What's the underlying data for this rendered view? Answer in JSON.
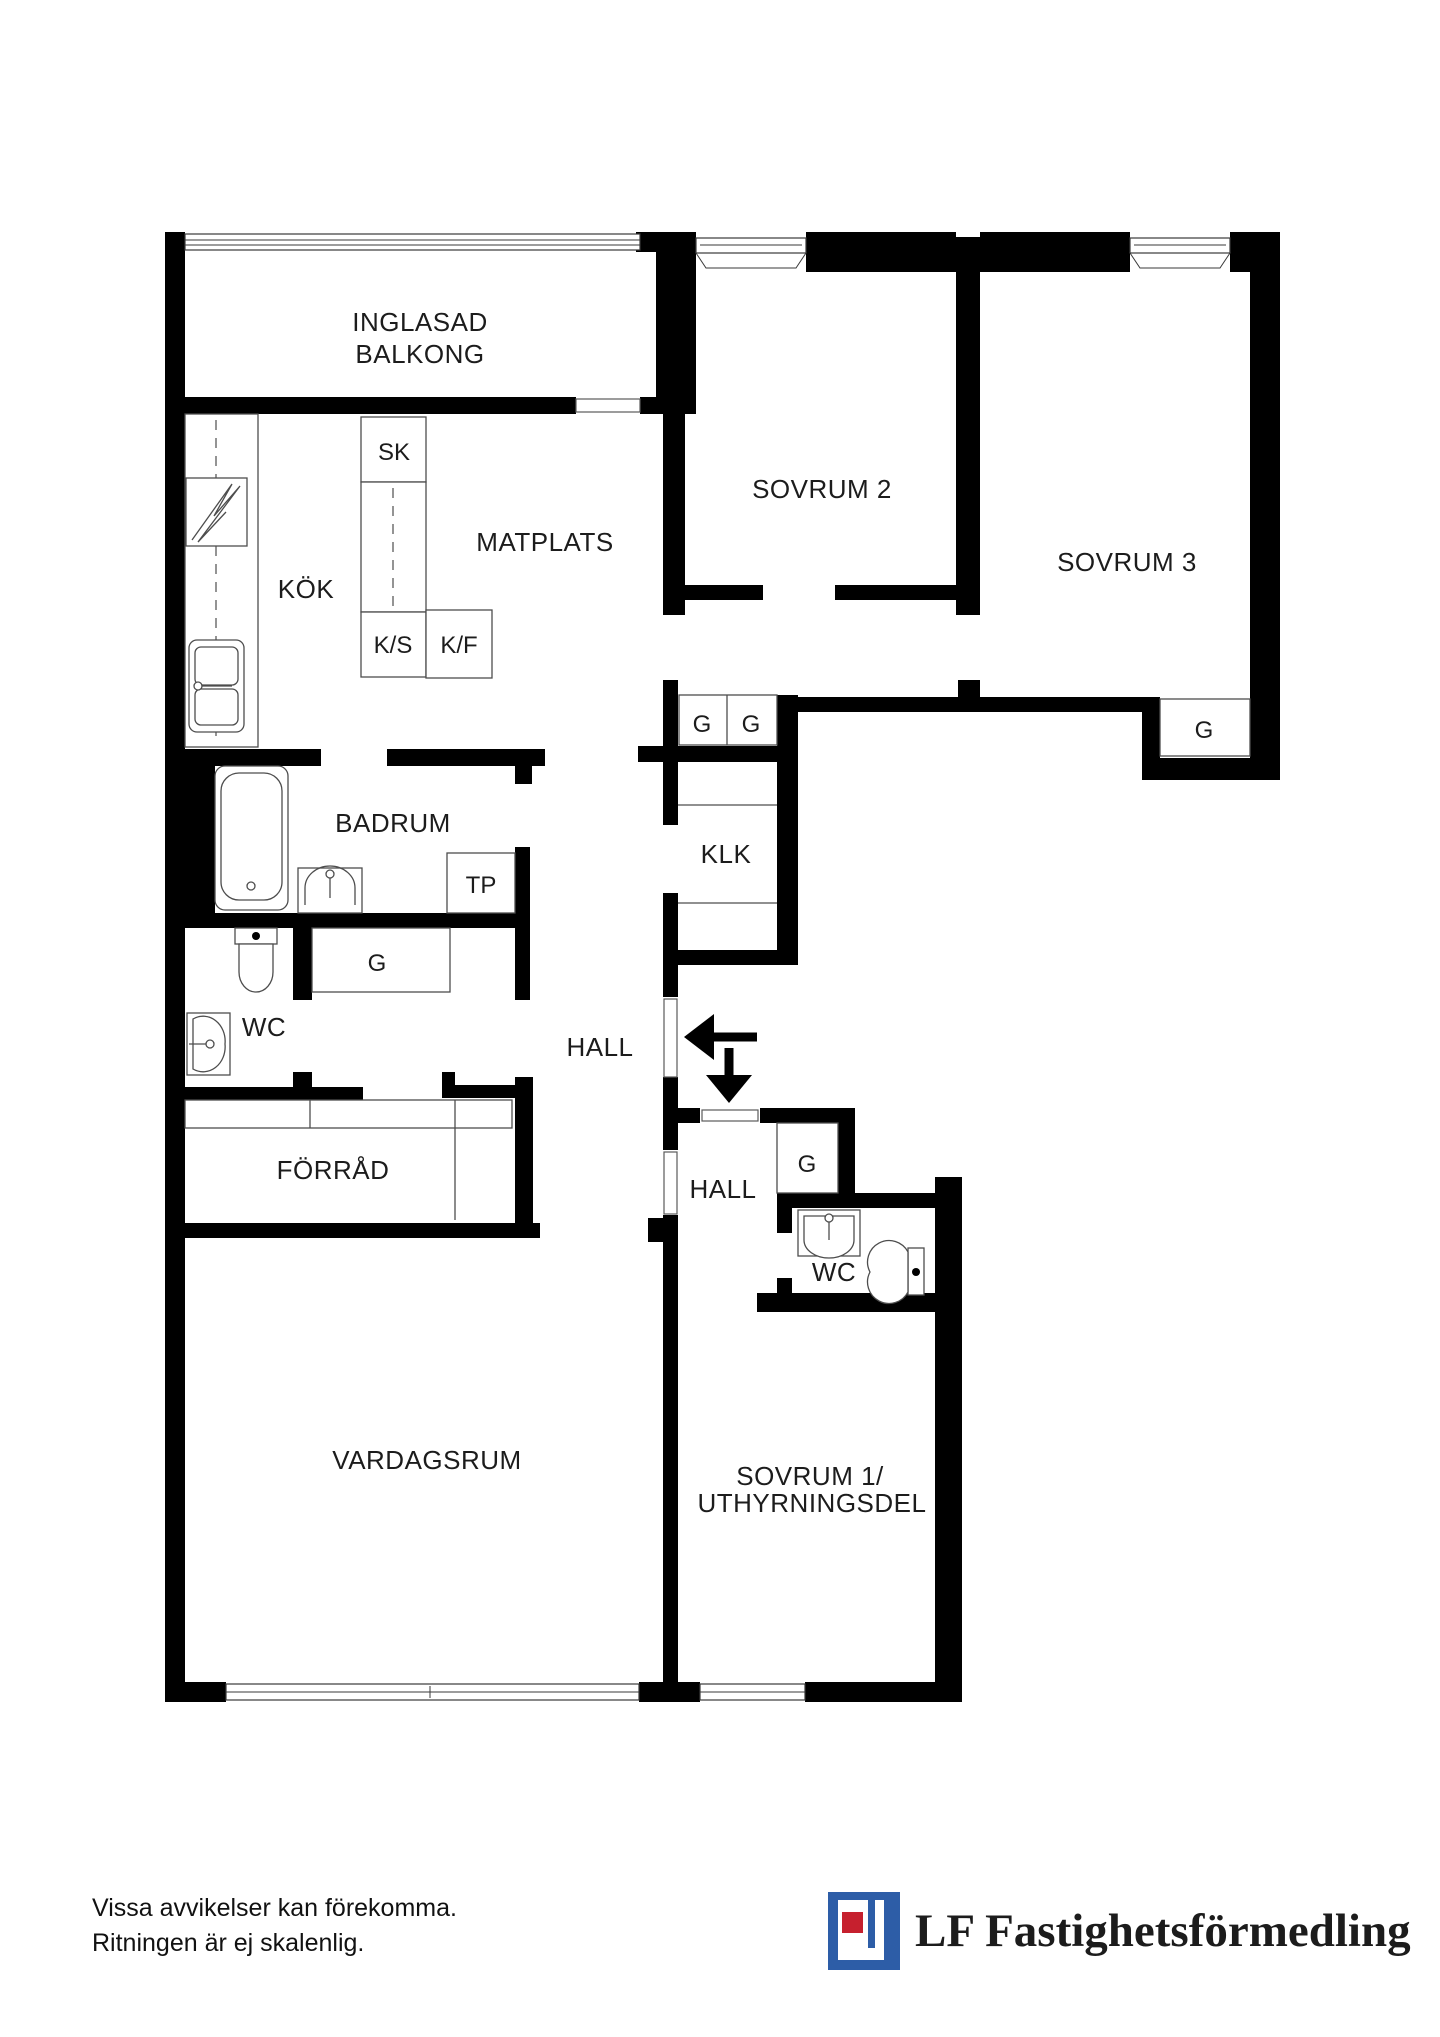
{
  "document": {
    "type": "apartment-floorplan"
  },
  "labels": {
    "balcony_line1": "INGLASAD",
    "balcony_line2": "BALKONG",
    "bedroom2": "SOVRUM 2",
    "bedroom3": "SOVRUM 3",
    "kitchen": "KÖK",
    "dining": "MATPLATS",
    "cabinet_sk": "SK",
    "cabinet_ks": "K/S",
    "cabinet_kf": "K/F",
    "bathroom": "BADRUM",
    "towel_dryer": "TP",
    "closet_bathroom": "G",
    "wc_upper": "WC",
    "hall_upper": "HALL",
    "closet_g1": "G",
    "closet_g2": "G",
    "walk_in_closet": "KLK",
    "closet_bedroom3": "G",
    "storage": "FÖRRÅD",
    "living_room": "VARDAGSRUM",
    "hall_lower": "HALL",
    "closet_hall_lower": "G",
    "wc_lower": "WC",
    "bedroom1_line1": "SOVRUM 1/",
    "bedroom1_line2": "UTHYRNINGSDEL"
  },
  "footer": {
    "disclaimer_line1": "Vissa avvikelser kan förekomma.",
    "disclaimer_line2": "Ritningen är ej skalenlig."
  },
  "logo": {
    "name": "LF Fastighetsförmedling",
    "blue": "#2d5da7",
    "red": "#c6202e"
  }
}
